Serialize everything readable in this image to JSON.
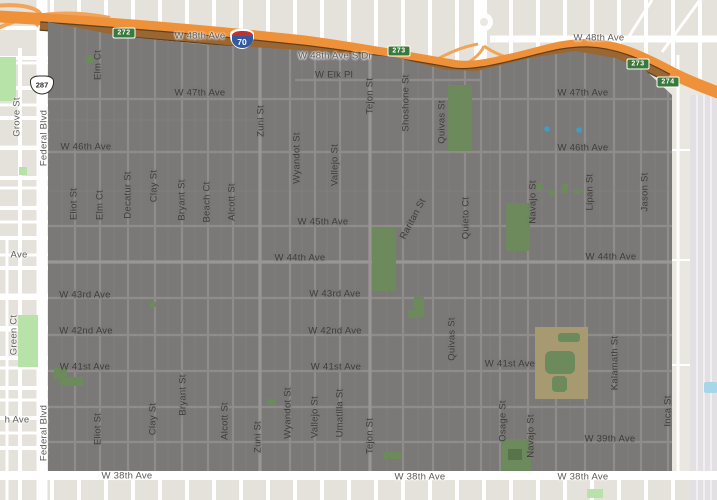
{
  "map": {
    "interstate_shield": "70",
    "us_route_shield": "287",
    "exit_shields": [
      {
        "id": "exit-272",
        "text": "272",
        "x": 124,
        "y": 33
      },
      {
        "id": "exit-273-a",
        "text": "273",
        "x": 399,
        "y": 51
      },
      {
        "id": "exit-273-b",
        "text": "273",
        "x": 638,
        "y": 64
      },
      {
        "id": "exit-274",
        "text": "274",
        "x": 668,
        "y": 82
      }
    ],
    "labels": [
      {
        "id": "w48th-ave-left",
        "text": "W 48th Ave",
        "x": 200,
        "y": 36,
        "kind": "h",
        "out": true
      },
      {
        "id": "w48th-ave-right",
        "text": "W 48th Ave",
        "x": 599,
        "y": 38,
        "kind": "h",
        "out": true
      },
      {
        "id": "w48th-ave-s-dr",
        "text": "W 48th Ave S Dr",
        "x": 335,
        "y": 56,
        "kind": "h",
        "out": true
      },
      {
        "id": "w-elk-pl",
        "text": "W Elk Pl",
        "x": 334,
        "y": 75,
        "kind": "h"
      },
      {
        "id": "w47th-ave-left",
        "text": "W 47th Ave",
        "x": 200,
        "y": 93,
        "kind": "h"
      },
      {
        "id": "w47th-ave-right",
        "text": "W 47th Ave",
        "x": 583,
        "y": 93,
        "kind": "h"
      },
      {
        "id": "w46th-ave-left",
        "text": "W 46th Ave",
        "x": 86,
        "y": 147,
        "kind": "h"
      },
      {
        "id": "w46th-ave-right",
        "text": "W 46th Ave",
        "x": 583,
        "y": 148,
        "kind": "h"
      },
      {
        "id": "w45th-ave",
        "text": "W 45th Ave",
        "x": 323,
        "y": 222,
        "kind": "h"
      },
      {
        "id": "w44th-ave-left-partial",
        "text": "Ave",
        "x": 19,
        "y": 255,
        "kind": "h",
        "out": true
      },
      {
        "id": "w44th-ave-center",
        "text": "W 44th Ave",
        "x": 300,
        "y": 258,
        "kind": "h"
      },
      {
        "id": "w44th-ave-right",
        "text": "W 44th Ave",
        "x": 611,
        "y": 257,
        "kind": "h"
      },
      {
        "id": "w43rd-ave-left",
        "text": "W 43rd Ave",
        "x": 85,
        "y": 295,
        "kind": "h"
      },
      {
        "id": "w43rd-ave-center",
        "text": "W 43rd Ave",
        "x": 335,
        "y": 294,
        "kind": "h"
      },
      {
        "id": "w42nd-ave-left",
        "text": "W 42nd Ave",
        "x": 86,
        "y": 331,
        "kind": "h"
      },
      {
        "id": "w42nd-ave-center",
        "text": "W 42nd Ave",
        "x": 335,
        "y": 331,
        "kind": "h"
      },
      {
        "id": "w41st-ave-left",
        "text": "W 41st Ave",
        "x": 85,
        "y": 367,
        "kind": "h"
      },
      {
        "id": "w41st-ave-center",
        "text": "W 41st Ave",
        "x": 336,
        "y": 367,
        "kind": "h"
      },
      {
        "id": "w41st-ave-right",
        "text": "W 41st Ave",
        "x": 510,
        "y": 364,
        "kind": "h"
      },
      {
        "id": "w40th-ave-partial",
        "text": "h Ave",
        "x": 17,
        "y": 420,
        "kind": "h",
        "out": true
      },
      {
        "id": "w39th-ave",
        "text": "W 39th Ave",
        "x": 610,
        "y": 439,
        "kind": "h"
      },
      {
        "id": "w38th-ave-left",
        "text": "W 38th Ave",
        "x": 127,
        "y": 476,
        "kind": "h",
        "out": true
      },
      {
        "id": "w38th-ave-center",
        "text": "W 38th Ave",
        "x": 420,
        "y": 477,
        "kind": "h",
        "out": true
      },
      {
        "id": "w38th-ave-right",
        "text": "W 38th Ave",
        "x": 583,
        "y": 477,
        "kind": "h",
        "out": true
      },
      {
        "id": "grove-st",
        "text": "Grove St",
        "x": 17,
        "y": 117,
        "kind": "v",
        "out": true
      },
      {
        "id": "federal-blvd-top",
        "text": "Federal Blvd",
        "x": 44,
        "y": 138,
        "kind": "v",
        "out": true
      },
      {
        "id": "federal-blvd-bottom",
        "text": "Federal Blvd",
        "x": 44,
        "y": 433,
        "kind": "v",
        "out": true
      },
      {
        "id": "green-ct",
        "text": "Green Ct",
        "x": 14,
        "y": 335,
        "kind": "v",
        "out": true
      },
      {
        "id": "elm-ct-top",
        "text": "Elm Ct",
        "x": 98,
        "y": 65,
        "kind": "v"
      },
      {
        "id": "eliot-st-top",
        "text": "Eliot St",
        "x": 74,
        "y": 204,
        "kind": "v"
      },
      {
        "id": "elm-ct-mid",
        "text": "Elm Ct",
        "x": 100,
        "y": 205,
        "kind": "v"
      },
      {
        "id": "decatur-st",
        "text": "Decatur St",
        "x": 128,
        "y": 195,
        "kind": "v"
      },
      {
        "id": "clay-st-top",
        "text": "Clay St",
        "x": 154,
        "y": 186,
        "kind": "v"
      },
      {
        "id": "bryant-st-top",
        "text": "Bryant St",
        "x": 182,
        "y": 200,
        "kind": "v"
      },
      {
        "id": "beach-ct",
        "text": "Beach Ct",
        "x": 207,
        "y": 202,
        "kind": "v"
      },
      {
        "id": "alcott-st-top",
        "text": "Alcott St",
        "x": 232,
        "y": 202,
        "kind": "v"
      },
      {
        "id": "zuni-st-top",
        "text": "Zuni St",
        "x": 261,
        "y": 121,
        "kind": "v"
      },
      {
        "id": "wyandot-st-top",
        "text": "Wyandot St",
        "x": 297,
        "y": 158,
        "kind": "v"
      },
      {
        "id": "vallejo-st-top",
        "text": "Vallejo St",
        "x": 335,
        "y": 165,
        "kind": "v"
      },
      {
        "id": "tejon-st-top",
        "text": "Tejon St",
        "x": 370,
        "y": 96,
        "kind": "v"
      },
      {
        "id": "shoshone-st",
        "text": "Shoshone St",
        "x": 406,
        "y": 103,
        "kind": "v"
      },
      {
        "id": "quivas-st-top",
        "text": "Quivas St",
        "x": 442,
        "y": 122,
        "kind": "v"
      },
      {
        "id": "raritan-st",
        "text": "Raritan St",
        "x": 413,
        "y": 219,
        "kind": "v",
        "rot": -62
      },
      {
        "id": "quieto-ct",
        "text": "Quieto Ct",
        "x": 466,
        "y": 218,
        "kind": "v"
      },
      {
        "id": "quivas-st-mid",
        "text": "Quivas St",
        "x": 452,
        "y": 339,
        "kind": "v"
      },
      {
        "id": "navajo-st-top",
        "text": "Navajo St",
        "x": 533,
        "y": 202,
        "kind": "v"
      },
      {
        "id": "lipan-st",
        "text": "Lipan St",
        "x": 590,
        "y": 192,
        "kind": "v"
      },
      {
        "id": "jason-st",
        "text": "Jason St",
        "x": 645,
        "y": 192,
        "kind": "v"
      },
      {
        "id": "eliot-st-bottom",
        "text": "Eliot St",
        "x": 98,
        "y": 429,
        "kind": "v"
      },
      {
        "id": "clay-st-bottom",
        "text": "Clay St",
        "x": 153,
        "y": 419,
        "kind": "v"
      },
      {
        "id": "bryant-st-bottom",
        "text": "Bryant St",
        "x": 183,
        "y": 395,
        "kind": "v"
      },
      {
        "id": "alcott-st-bottom",
        "text": "Alcott St",
        "x": 225,
        "y": 421,
        "kind": "v"
      },
      {
        "id": "zuni-st-bottom",
        "text": "Zuni St",
        "x": 258,
        "y": 437,
        "kind": "v"
      },
      {
        "id": "wyandot-st-bottom",
        "text": "Wyandot St",
        "x": 288,
        "y": 413,
        "kind": "v"
      },
      {
        "id": "vallejo-st-bottom",
        "text": "Vallejo St",
        "x": 315,
        "y": 417,
        "kind": "v"
      },
      {
        "id": "umatilla-st",
        "text": "Umatilla St",
        "x": 340,
        "y": 413,
        "kind": "v"
      },
      {
        "id": "tejon-st-bottom",
        "text": "Tejon St",
        "x": 370,
        "y": 436,
        "kind": "v"
      },
      {
        "id": "osage-st",
        "text": "Osage St",
        "x": 503,
        "y": 421,
        "kind": "v"
      },
      {
        "id": "navajo-st-bottom",
        "text": "Navajo St",
        "x": 531,
        "y": 436,
        "kind": "v"
      },
      {
        "id": "kalamath-st",
        "text": "Kalamath St",
        "x": 615,
        "y": 363,
        "kind": "v"
      },
      {
        "id": "inca-st",
        "text": "Inca St",
        "x": 668,
        "y": 411,
        "kind": "v"
      }
    ],
    "colors": {
      "overlay_gray": "#7b7978",
      "motorway_orange": "#ef9139",
      "frontage_brown": "#9a6733",
      "exit_shield_green": "#39793b",
      "park_green_outside": "#b7e3a8",
      "park_green_inside": "#6c8a5c",
      "field_tan": "#a79a70",
      "pool_blue": "#3d9ec0"
    }
  }
}
